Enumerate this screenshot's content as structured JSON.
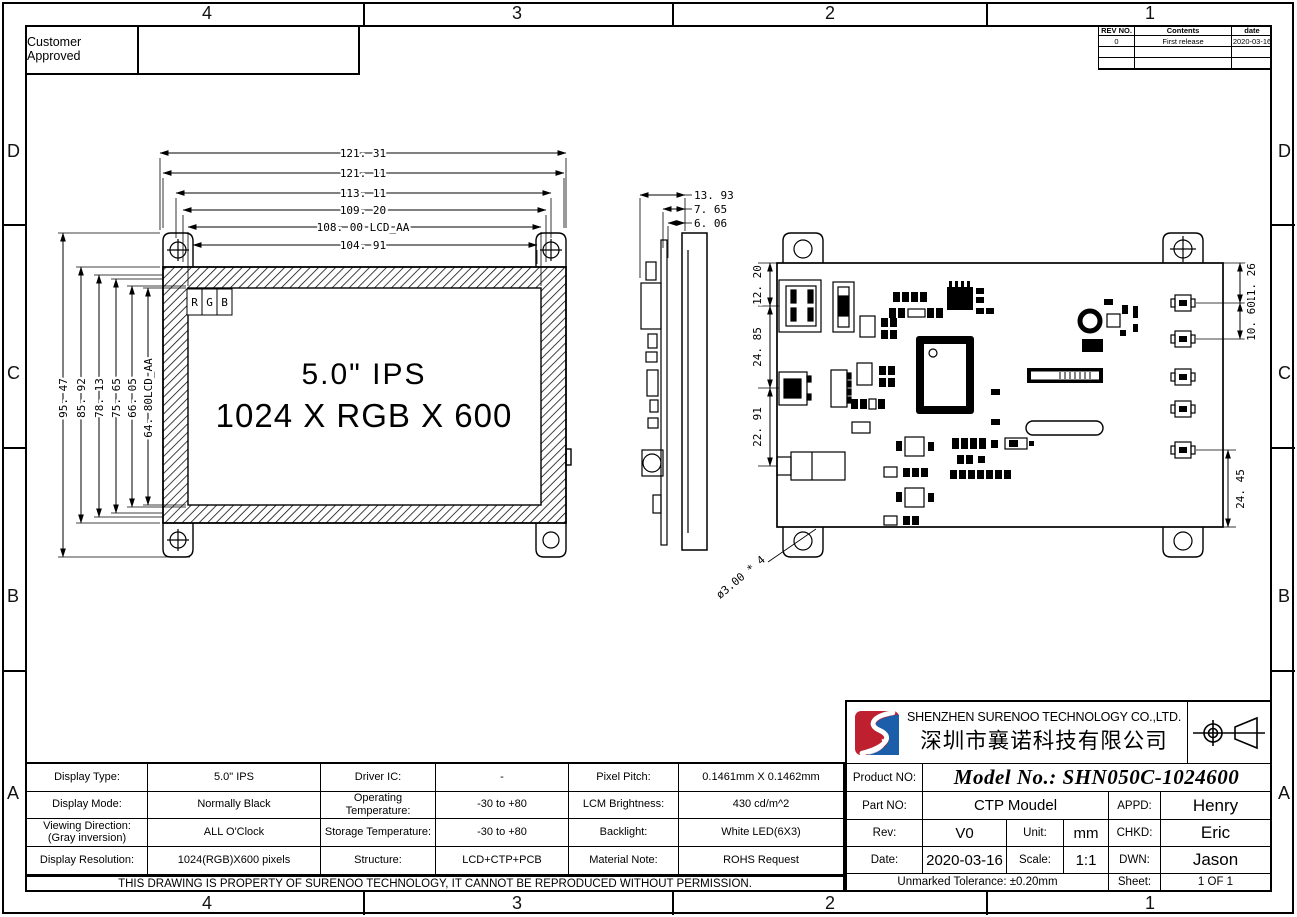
{
  "zones": {
    "top": [
      "4",
      "3",
      "2",
      "1"
    ],
    "bottom": [
      "4",
      "3",
      "2",
      "1"
    ],
    "left": [
      "D",
      "C",
      "B",
      "A"
    ],
    "right": [
      "D",
      "C",
      "B",
      "A"
    ]
  },
  "approval": {
    "label": "Customer Approved"
  },
  "revision_table": {
    "headers": [
      "REV NO.",
      "Contents",
      "date"
    ],
    "rows": [
      [
        "0",
        "First release",
        "2020-03-16"
      ],
      [
        "",
        "",
        ""
      ],
      [
        "",
        "",
        ""
      ]
    ]
  },
  "front_view": {
    "line1": "5.0\" IPS",
    "line2": "1024 X RGB X 600",
    "rgb": [
      "R",
      "G",
      "B"
    ],
    "dims_top": [
      "121. 31",
      "121. 11",
      "113. 11",
      "109. 20",
      "108. 00 LCD_AA",
      "104. 91"
    ],
    "dims_left": [
      "95. 47",
      "85. 92",
      "78. 13",
      "75. 65",
      "66. 05",
      "64. 80LCD_AA"
    ]
  },
  "side_view": {
    "dims": [
      "13. 93",
      "7. 65",
      "6. 06"
    ]
  },
  "back_view": {
    "dims_left": [
      "12. 20",
      "24. 85",
      "22. 91"
    ],
    "dims_right": [
      "11. 26",
      "10. 60",
      "24. 45"
    ],
    "hole_note": "ø3.00 * 4"
  },
  "company": {
    "name_en": "SHENZHEN SURENOO TECHNOLOGY CO.,LTD.",
    "name_cn": "深圳市襄诺科技有限公司"
  },
  "title_block": {
    "product_no_label": "Product NO:",
    "model_no": "Model No.: SHN050C-1024600",
    "part_no_label": "Part NO:",
    "part_no": "CTP Moudel",
    "appd_label": "APPD:",
    "appd": "Henry",
    "rev_label": "Rev:",
    "rev": "V0",
    "unit_label": "Unit:",
    "unit": "mm",
    "chkd_label": "CHKD:",
    "chkd": "Eric",
    "date_label": "Date:",
    "date": "2020-03-16",
    "scale_label": "Scale:",
    "scale": "1:1",
    "dwn_label": "DWN:",
    "dwn": "Jason",
    "tolerance": "Unmarked Tolerance:  ±0.20mm",
    "sheet_label": "Sheet:",
    "sheet": "1 OF 1"
  },
  "spec_table": {
    "rows": [
      [
        "Display Type:",
        "5.0\" IPS",
        "Driver IC:",
        "-",
        "Pixel Pitch:",
        "0.1461mm X 0.1462mm"
      ],
      [
        "Display Mode:",
        "Normally Black",
        "Operating Temperature:",
        "-30  to +80",
        "LCM Brightness:",
        "430 cd/m^2"
      ],
      [
        "Viewing Direction:\n(Gray inversion)",
        "ALL O'Clock",
        "Storage Temperature:",
        "-30  to +80",
        "Backlight:",
        "White LED(6X3)"
      ],
      [
        "Display Resolution:",
        "1024(RGB)X600 pixels",
        "Structure:",
        "LCD+CTP+PCB",
        "Material Note:",
        "ROHS Request"
      ]
    ],
    "footer": "THIS DRAWING IS PROPERTY OF SURENOO TECHNOLOGY, IT CANNOT BE REPRODUCED WITHOUT PERMISSION."
  }
}
